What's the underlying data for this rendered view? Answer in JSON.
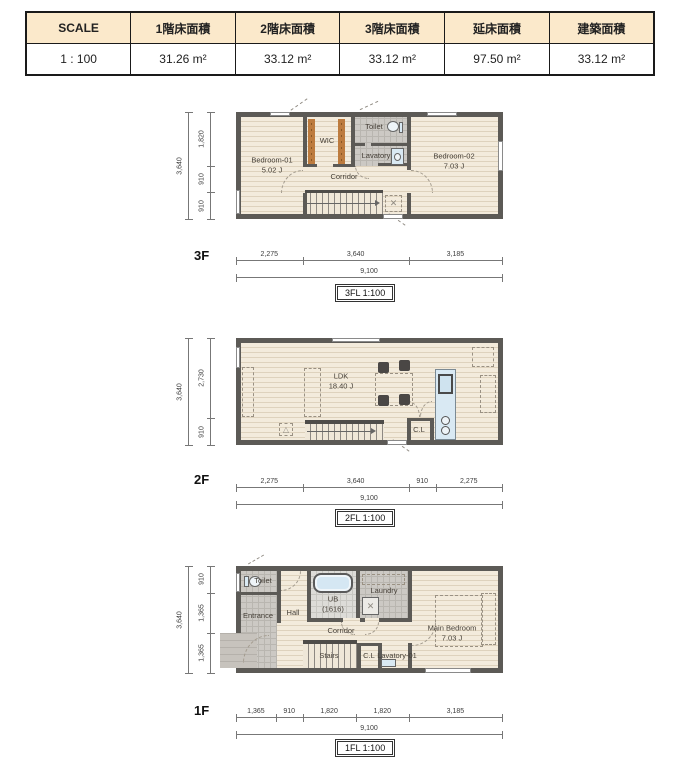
{
  "title_table": {
    "headers": [
      "SCALE",
      "1階床面積",
      "2階床面積",
      "3階床面積",
      "延床面積",
      "建築面積"
    ],
    "values": [
      "1 : 100",
      "31.26 m²",
      "33.12 m²",
      "33.12 m²",
      "97.50 m²",
      "33.12 m²"
    ]
  },
  "floors": {
    "f3": {
      "label": "3F",
      "caption": "3FL  1:100",
      "rooms": {
        "bedroom01": {
          "name": "Bedroom-01",
          "area": "5.02 J"
        },
        "wic": "WIC",
        "toilet": "Toilet",
        "lavatory": "Lavatory",
        "corridor": "Corridor",
        "bedroom02": {
          "name": "Bedroom-02",
          "area": "7.03 J"
        }
      },
      "dims": {
        "left_total": "3,640",
        "left_segments": [
          "1,820",
          "910",
          "910"
        ],
        "bottom_total": "9,100",
        "bottom_segments": [
          "2,275",
          "3,640",
          "3,185"
        ]
      }
    },
    "f2": {
      "label": "2F",
      "caption": "2FL  1:100",
      "rooms": {
        "ldk": {
          "name": "LDK",
          "area": "18.40 J"
        },
        "cl": "C.L"
      },
      "dims": {
        "left_total": "3,640",
        "left_segments": [
          "2,730",
          "910"
        ],
        "bottom_total": "9,100",
        "bottom_segments": [
          "2,275",
          "3,640",
          "910",
          "2,275"
        ]
      }
    },
    "f1": {
      "label": "1F",
      "caption": "1FL  1:100",
      "rooms": {
        "toilet": "Toilet",
        "entrance": "Entrance",
        "hall": "Hall",
        "ub": {
          "name": "UB",
          "area": "(1616)"
        },
        "laundry": "Laundry",
        "corridor": "Corridor",
        "stairs": "Stairs",
        "cl": "C.L",
        "lavatory": "Lavatory-01",
        "main_bedroom": {
          "name": "Main Bedroom",
          "area": "7.03 J"
        }
      },
      "dims": {
        "left_total": "3,640",
        "left_segments": [
          "910",
          "1,365",
          "1,365"
        ],
        "bottom_total": "9,100",
        "bottom_segments": [
          "1,365",
          "910",
          "1,820",
          "1,820",
          "3,185"
        ]
      }
    }
  },
  "colors": {
    "wall": "#5c5a56",
    "wood_floor": "#f3ebdc",
    "tile": "#ccc9c4",
    "fixture_blue": "#d9e9f3",
    "closet_rod_orange": "#bd7b3e",
    "table_header_bg": "#fbe9cb"
  }
}
